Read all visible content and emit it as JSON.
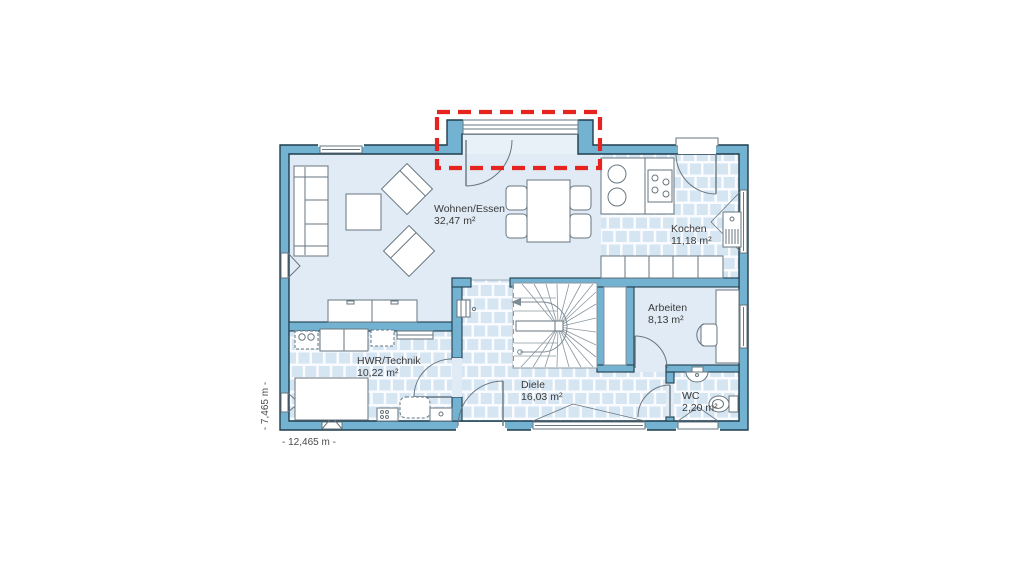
{
  "plan": {
    "type": "floor-plan",
    "rooms": [
      {
        "name": "Wohnen/Essen",
        "area": "32,47 m²"
      },
      {
        "name": "Kochen",
        "area": "11,18 m²"
      },
      {
        "name": "Arbeiten",
        "area": "8,13 m²"
      },
      {
        "name": "HWR/Technik",
        "area": "10,22 m²"
      },
      {
        "name": "Diele",
        "area": "16,03 m²"
      },
      {
        "name": "WC",
        "area": "2,20 m²"
      }
    ],
    "dimensions": {
      "overall_width": "- 12,465 m -",
      "overall_height": "- 7,465 m -"
    },
    "highlight": {
      "description": "terrace-door-recess-highlight",
      "color": "#e5231f"
    },
    "colors": {
      "wall_fill": "#74b2d2",
      "wall_outline": "#1f3d4d",
      "room_fill": "#e0ebf5",
      "tile_fill": "#d6e5f2",
      "tile_grout": "#f9fbfe",
      "furniture_outline": "#67767f",
      "label_text": "#3a3a3a"
    }
  }
}
